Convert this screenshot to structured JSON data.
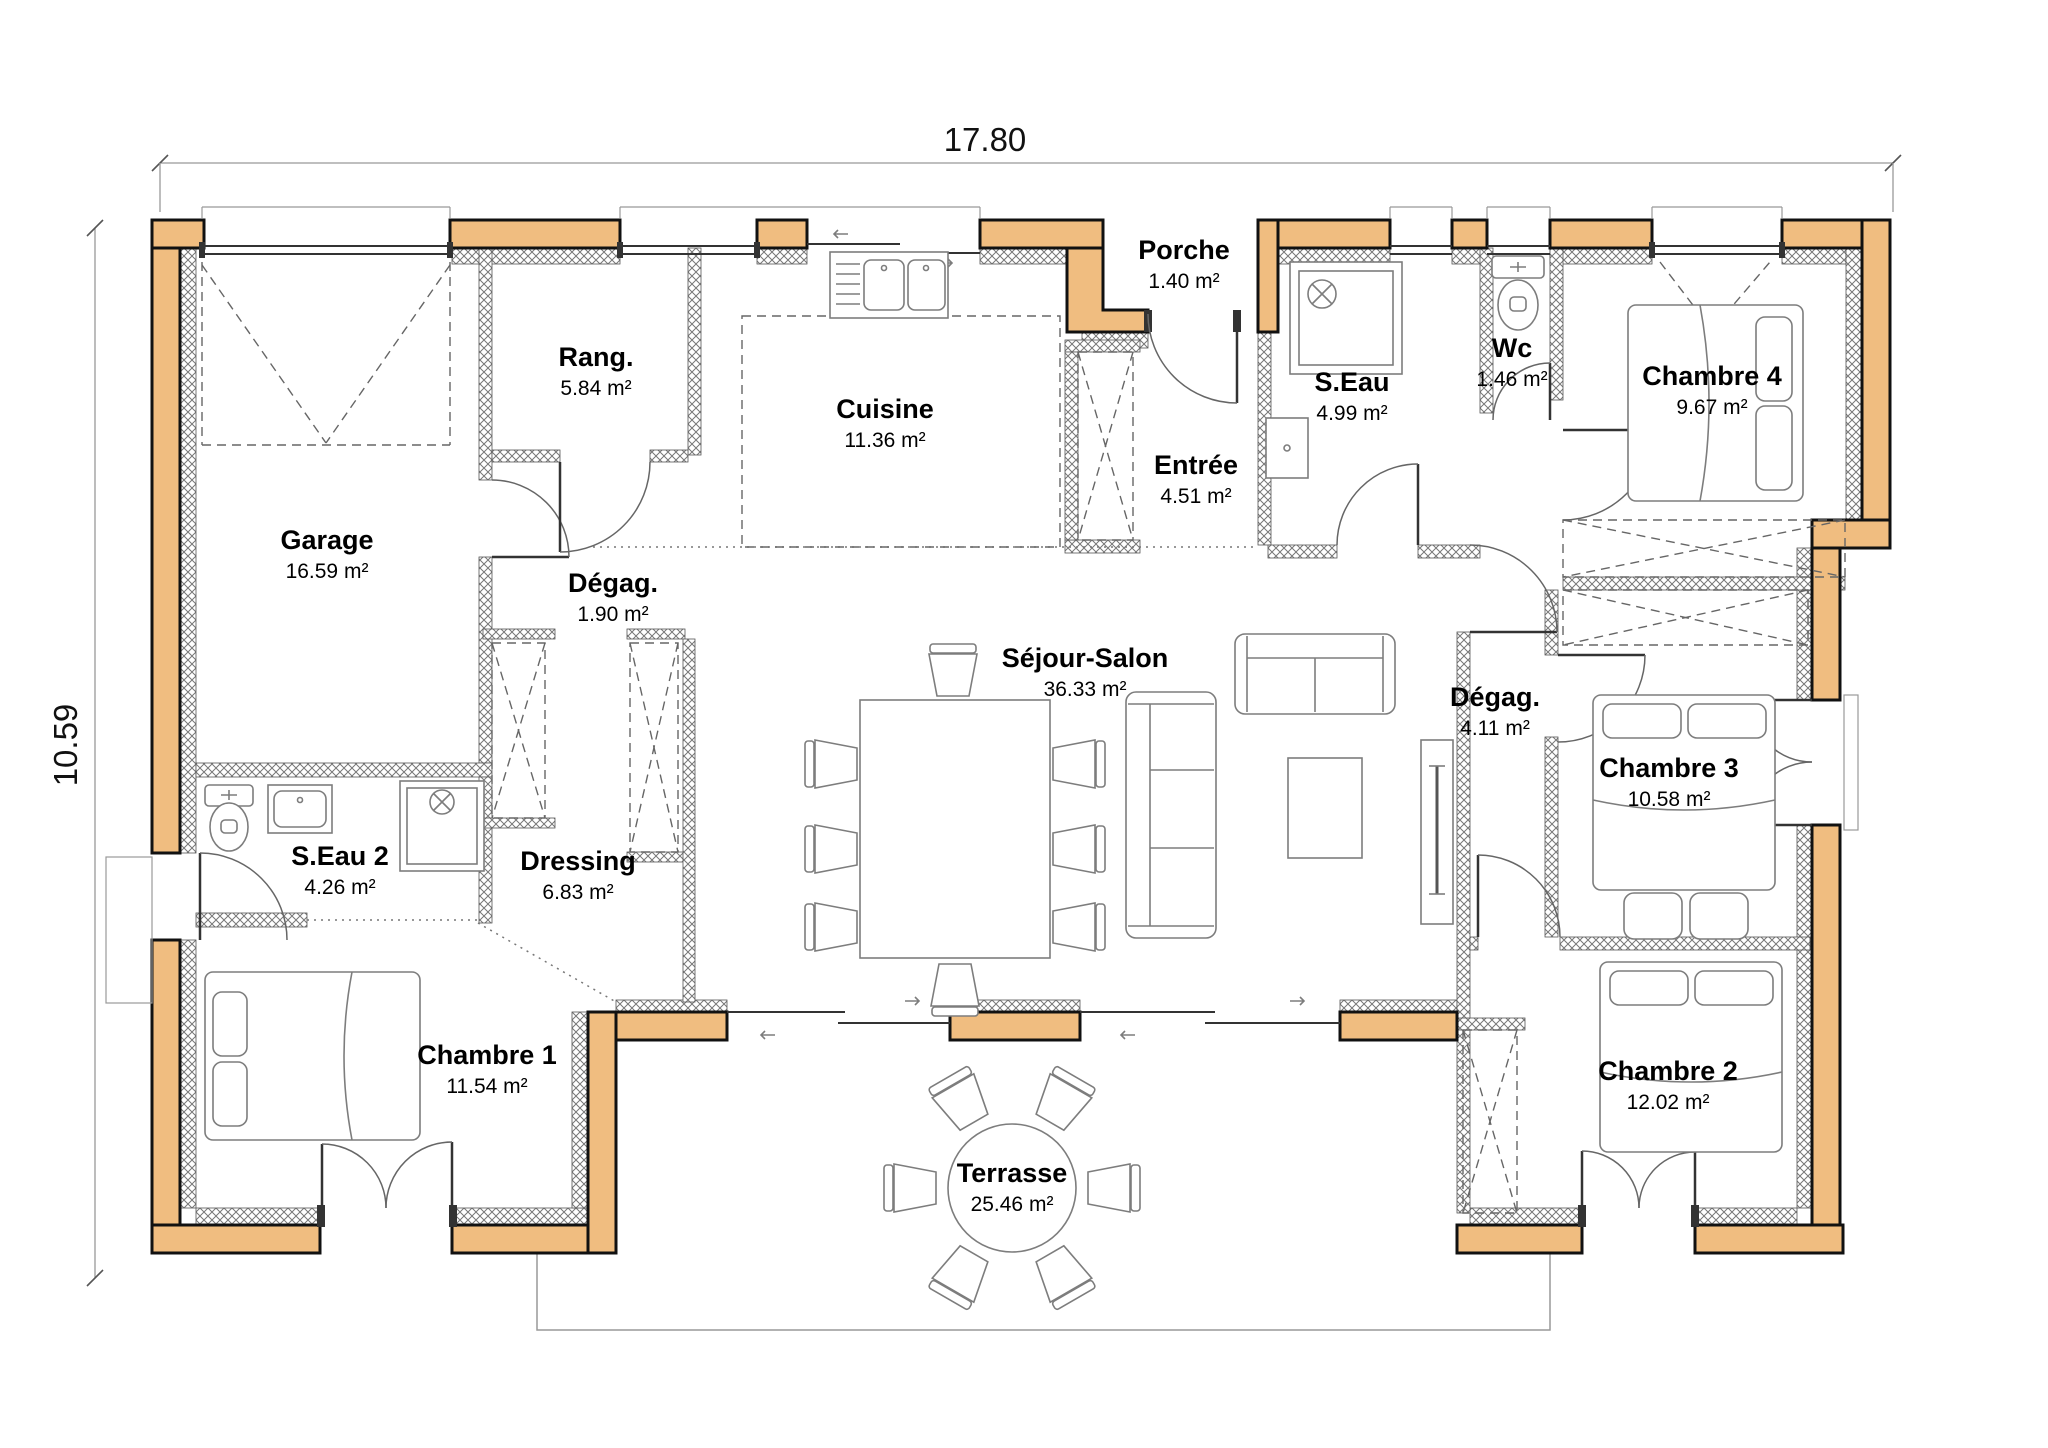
{
  "dimensions": {
    "width": "17.80",
    "height": "10.59"
  },
  "area_unit": "m²",
  "colors": {
    "exterior_wall": "#F0BD80",
    "wall_outline": "#111111",
    "furniture_stroke": "#7d7d7d"
  },
  "rooms": [
    {
      "name": "Garage",
      "area": "16.59 m²"
    },
    {
      "name": "Rang.",
      "area": "5.84 m²"
    },
    {
      "name": "Cuisine",
      "area": "11.36 m²"
    },
    {
      "name": "Porche",
      "area": "1.40 m²"
    },
    {
      "name": "Entrée",
      "area": "4.51 m²"
    },
    {
      "name": "S.Eau",
      "area": "4.99 m²"
    },
    {
      "name": "Wc",
      "area": "1.46 m²"
    },
    {
      "name": "Chambre 4",
      "area": "9.67 m²"
    },
    {
      "name": "Dégag.",
      "area": "1.90 m²"
    },
    {
      "name": "Séjour-Salon",
      "area": "36.33 m²"
    },
    {
      "name": "Dégag.",
      "area": "4.11 m²"
    },
    {
      "name": "Chambre 3",
      "area": "10.58 m²"
    },
    {
      "name": "S.Eau 2",
      "area": "4.26 m²"
    },
    {
      "name": "Dressing",
      "area": "6.83 m²"
    },
    {
      "name": "Chambre 1",
      "area": "11.54 m²"
    },
    {
      "name": "Chambre 2",
      "area": "12.02 m²"
    },
    {
      "name": "Terrasse",
      "area": "25.46 m²"
    }
  ]
}
